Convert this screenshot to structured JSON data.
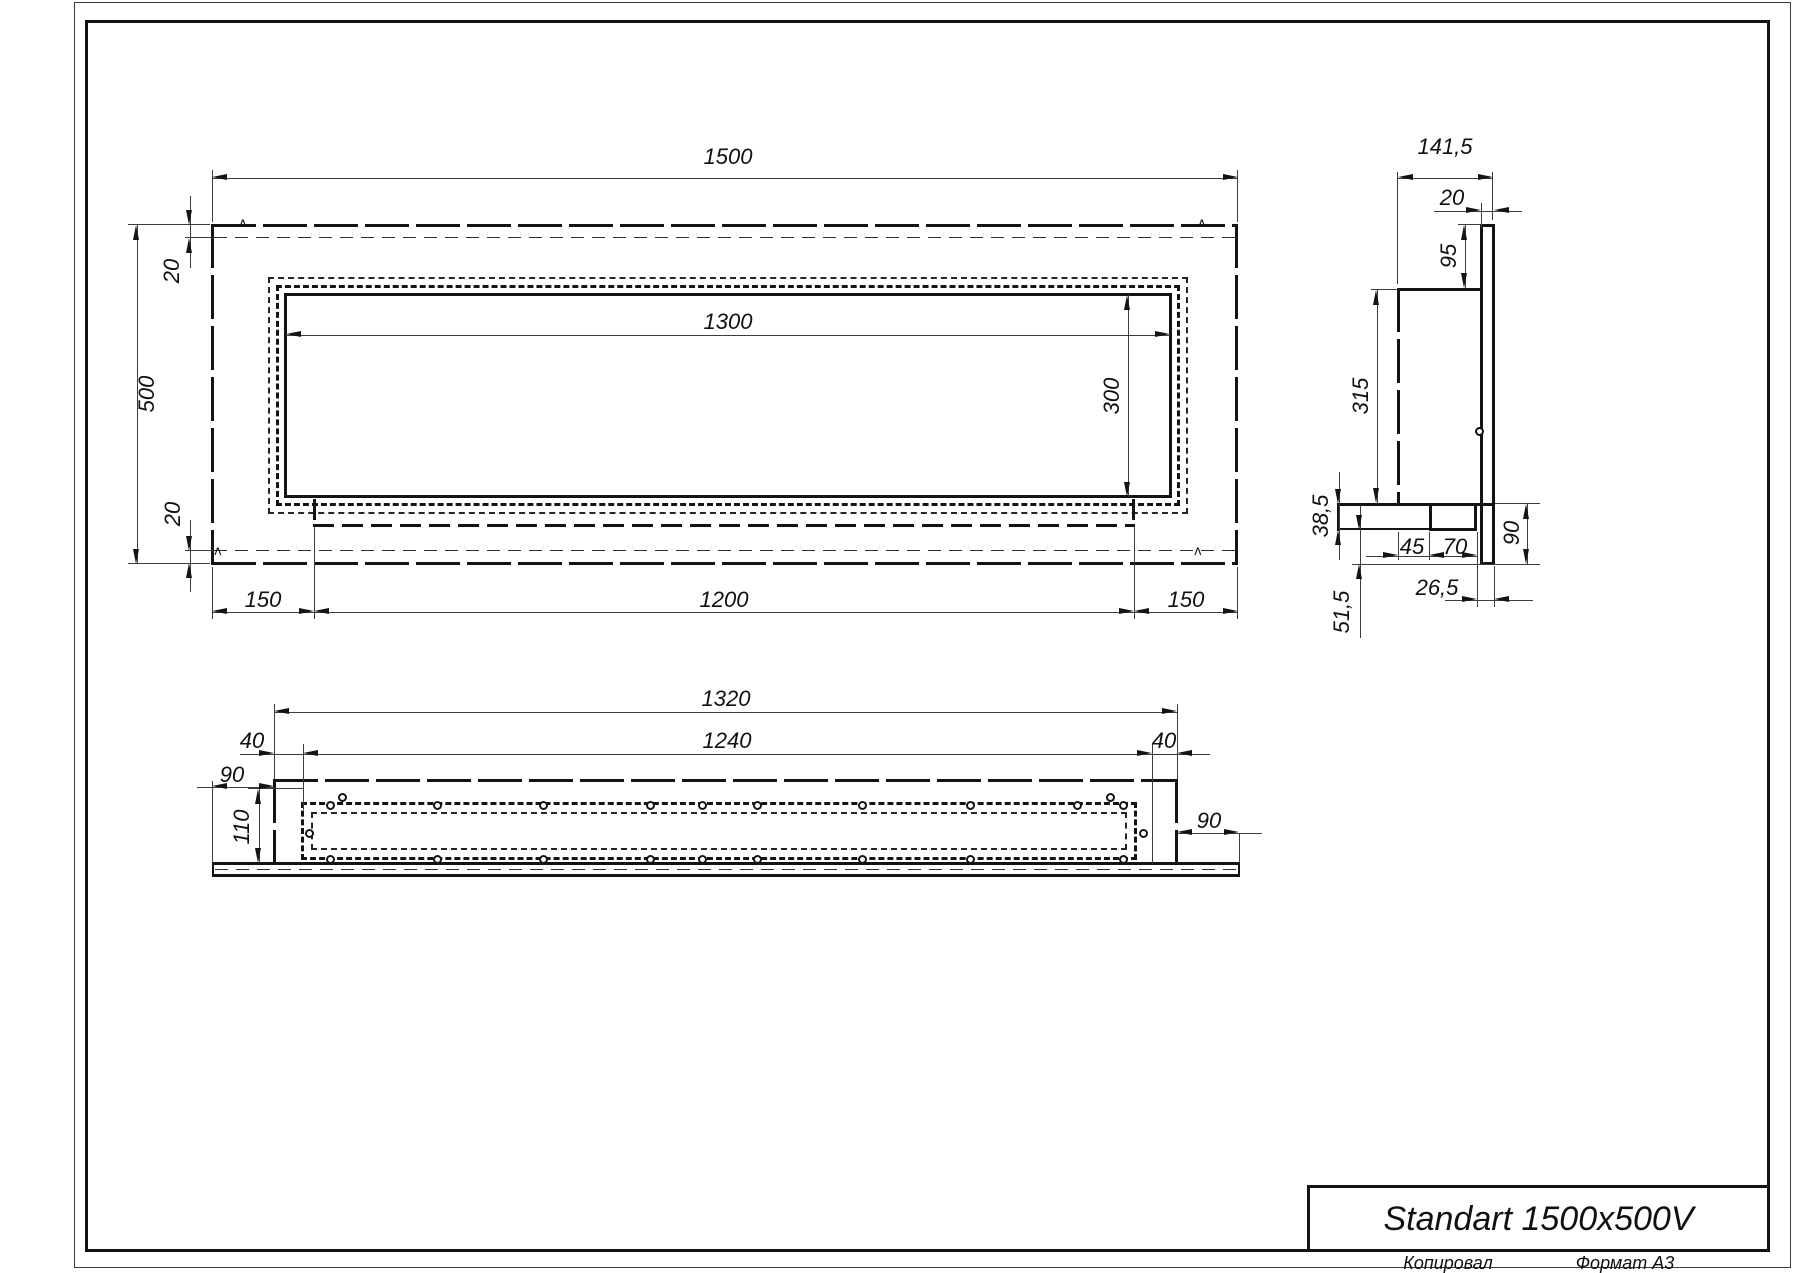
{
  "title_block": {
    "title": "Standart 1500x500V"
  },
  "page": {
    "copied_by": "Копировал",
    "format_note": "Формат А3"
  },
  "front_view": {
    "dim_width": "1500",
    "dim_height": "500",
    "dim_top_inset": "20",
    "dim_bottom_inset": "20",
    "dim_opening_width": "1300",
    "dim_opening_height": "300",
    "dim_left_offset": "150",
    "dim_burner_width": "1200",
    "dim_right_offset": "150",
    "weld_mark": "ʌ"
  },
  "side_view": {
    "dim_depth": "141,5",
    "dim_flange_width": "20",
    "dim_top_offset": "95",
    "dim_body_height": "315",
    "dim_step_height": "38,5",
    "dim_lower_height": "51,5",
    "dim_shelf_inset": "45",
    "dim_tray_width": "70",
    "dim_bottom_overhang": "90",
    "dim_front_offset": "26,5"
  },
  "bottom_view": {
    "dim_outer_width": "1320",
    "dim_inner_width": "1240",
    "dim_left_inset": "40",
    "dim_right_inset": "40",
    "dim_left_overhang": "90",
    "dim_right_overhang": "90",
    "dim_depth": "110"
  }
}
